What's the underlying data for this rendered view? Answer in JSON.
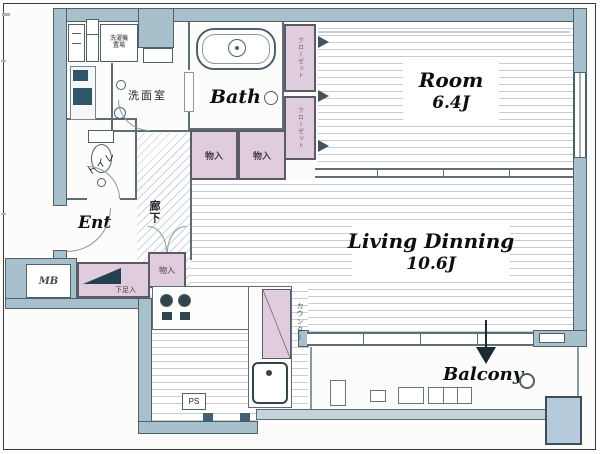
{
  "floorplan": {
    "rooms": {
      "room": {
        "name": "Room",
        "size": "6.4J"
      },
      "living": {
        "name": "Living Dinning",
        "size": "10.6J"
      },
      "bath": {
        "name": "Bath"
      },
      "washroom": {
        "name": "洗面室"
      },
      "toilet": {
        "name": "トイレ"
      },
      "entrance": {
        "name": "Ent"
      },
      "hallway": {
        "name": "廊下"
      },
      "balcony": {
        "name": "Balcony"
      }
    },
    "storage": {
      "closet_upper": "クローゼット",
      "closet_lower": "クローゼット",
      "futon_left": "物入",
      "futon_right": "物入",
      "hall_storage": "物入",
      "shoe_cabinet": "下足入",
      "washer_space": "洗濯機置場",
      "counter": "カウンター"
    },
    "service": {
      "meter_box": "MB",
      "pipe_space": "PS"
    },
    "colors": {
      "wall": "#a7c0cc",
      "storage": "#dfcdde",
      "machine_space": "#b5cbdb",
      "floor_line": "#c6ccd0"
    }
  }
}
